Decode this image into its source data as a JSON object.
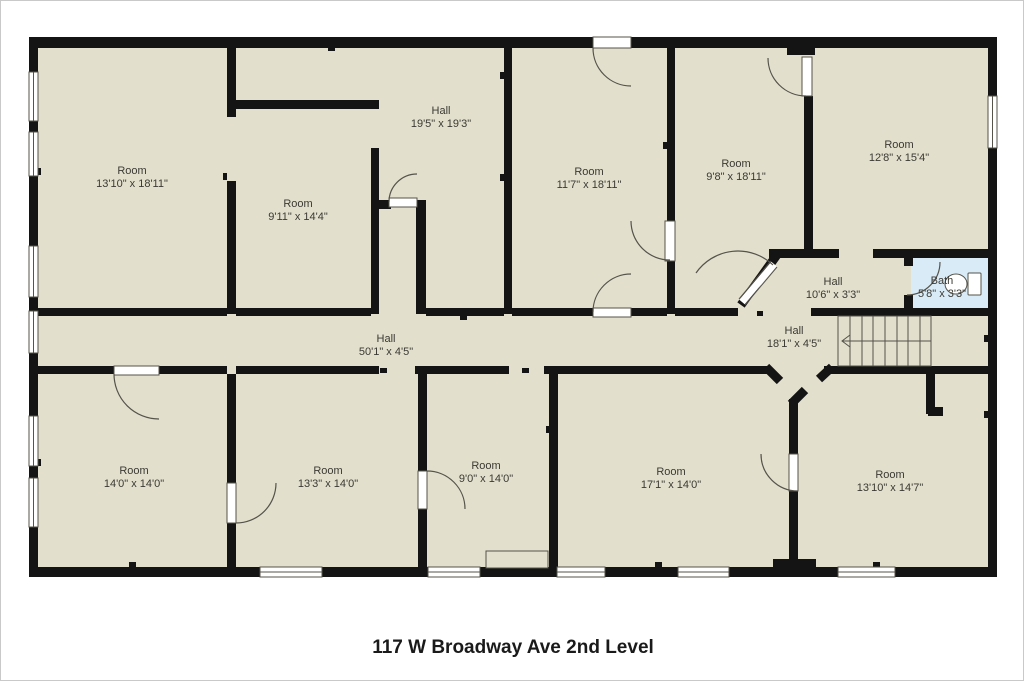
{
  "title": "117 W Broadway Ave 2nd Level",
  "colors": {
    "canvas": "#ffffff",
    "frame": "#c9c9c9",
    "floor": "#e2dfcd",
    "wall": "#141414",
    "bath_floor": "#d9ebf7",
    "line": "#55534a",
    "label": "#3b3a33",
    "title_color": "#1a1a1a"
  },
  "rooms": [
    {
      "name": "Room",
      "dims": "13'10\" x 18'11\""
    },
    {
      "name": "Room",
      "dims": "9'11\" x 14'4\""
    },
    {
      "name": "Hall",
      "dims": "19'5\" x 19'3\""
    },
    {
      "name": "Room",
      "dims": "11'7\" x 18'11\""
    },
    {
      "name": "Room",
      "dims": "9'8\" x 18'11\""
    },
    {
      "name": "Room",
      "dims": "12'8\" x 15'4\""
    },
    {
      "name": "Hall",
      "dims": "10'6\" x 3'3\""
    },
    {
      "name": "Bath",
      "dims": "5'8\" x 3'3\""
    },
    {
      "name": "Hall",
      "dims": "50'1\" x 4'5\""
    },
    {
      "name": "Hall",
      "dims": "18'1\" x 4'5\""
    },
    {
      "name": "Room",
      "dims": "14'0\" x 14'0\""
    },
    {
      "name": "Room",
      "dims": "13'3\" x 14'0\""
    },
    {
      "name": "Room",
      "dims": "9'0\" x 14'0\""
    },
    {
      "name": "Room",
      "dims": "17'1\" x 14'0\""
    },
    {
      "name": "Room",
      "dims": "13'10\" x 14'7\""
    }
  ],
  "stairs": {
    "direction_arrow": "left"
  }
}
